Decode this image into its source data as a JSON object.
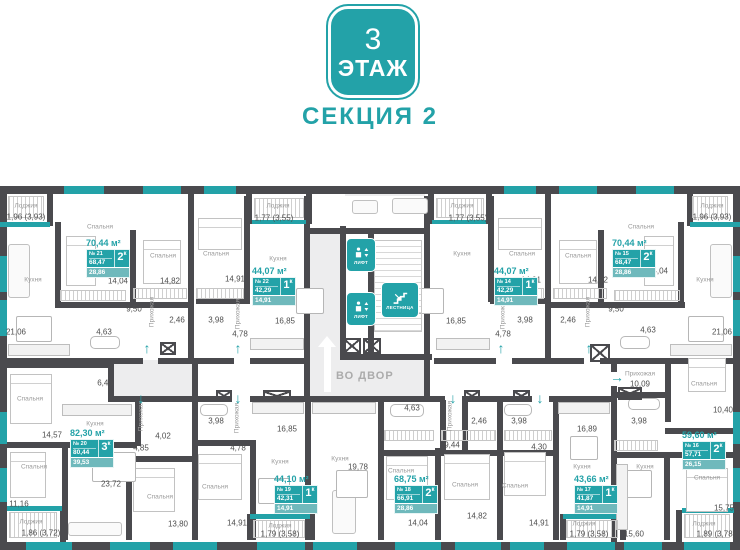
{
  "header": {
    "floor_number": "3",
    "floor_word": "ЭТАЖ",
    "section_label": "СЕКЦИЯ 2"
  },
  "colors": {
    "teal": "#23a2a8",
    "wall": "#4a4a4e",
    "outside": "#ededee",
    "badge_living_strip": "#6fb9bc"
  },
  "core": {
    "lift_label": "ЛИФТ",
    "stairs_label": "ЛЕСТНИЦА",
    "exit_label": "ВО ДВОР"
  },
  "apartments": [
    {
      "id": "21",
      "number": "№ 21",
      "rooms": "2",
      "rooms_unit": "к",
      "area_title": "70,44 м²",
      "area_total": "68,47",
      "area_living": "28,86",
      "x": 86,
      "y": 238
    },
    {
      "id": "22",
      "number": "№ 22",
      "rooms": "1",
      "rooms_unit": "к",
      "area_title": "44,07 м²",
      "area_total": "42,29",
      "area_living": "14,91",
      "x": 252,
      "y": 266
    },
    {
      "id": "14",
      "number": "№ 14",
      "rooms": "1",
      "rooms_unit": "к",
      "area_title": "44,07 м²",
      "area_total": "42,29",
      "area_living": "14,91",
      "x": 494,
      "y": 266
    },
    {
      "id": "15",
      "number": "№ 15",
      "rooms": "2",
      "rooms_unit": "к",
      "area_title": "70,44 м²",
      "area_total": "68,47",
      "area_living": "28,86",
      "x": 612,
      "y": 238
    },
    {
      "id": "20",
      "number": "№ 20",
      "rooms": "3",
      "rooms_unit": "к",
      "area_title": "82,30 м²",
      "area_total": "80,44",
      "area_living": "39,53",
      "x": 70,
      "y": 428
    },
    {
      "id": "19",
      "number": "№ 19",
      "rooms": "1",
      "rooms_unit": "к",
      "area_title": "44,10 м²",
      "area_total": "42,31",
      "area_living": "14,91",
      "x": 274,
      "y": 474
    },
    {
      "id": "18",
      "number": "№ 18",
      "rooms": "2",
      "rooms_unit": "к",
      "area_title": "68,75 м²",
      "area_total": "66,91",
      "area_living": "28,86",
      "x": 394,
      "y": 474
    },
    {
      "id": "17",
      "number": "№ 17",
      "rooms": "1",
      "rooms_unit": "к",
      "area_title": "43,66 м²",
      "area_total": "41,87",
      "area_living": "14,91",
      "x": 574,
      "y": 474
    },
    {
      "id": "16",
      "number": "№ 16",
      "rooms": "2",
      "rooms_unit": "к",
      "area_title": "59,60 м²",
      "area_total": "57,71",
      "area_living": "26,15",
      "x": 682,
      "y": 430
    }
  ],
  "room_labels": [
    [
      "Лоджия",
      26,
      206,
      0
    ],
    [
      "Спальня",
      100,
      227,
      0
    ],
    [
      "Спальня",
      163,
      256,
      0
    ],
    [
      "Кухня",
      33,
      280,
      0
    ],
    [
      "Прихожая",
      152,
      312,
      1
    ],
    [
      "Лоджия",
      278,
      206,
      0
    ],
    [
      "Спальня",
      216,
      254,
      0
    ],
    [
      "Кухня",
      278,
      259,
      0
    ],
    [
      "Прихожая",
      238,
      314,
      1
    ],
    [
      "Лоджия",
      462,
      206,
      0
    ],
    [
      "Кухня",
      462,
      254,
      0
    ],
    [
      "Спальня",
      522,
      254,
      0
    ],
    [
      "Прихожая",
      503,
      314,
      1
    ],
    [
      "Лоджия",
      712,
      206,
      0
    ],
    [
      "Спальня",
      641,
      227,
      0
    ],
    [
      "Спальня",
      578,
      256,
      0
    ],
    [
      "Кухня",
      705,
      280,
      0
    ],
    [
      "Прихожая",
      588,
      312,
      1
    ],
    [
      "Спальня",
      30,
      399,
      0
    ],
    [
      "Кухня",
      95,
      424,
      0
    ],
    [
      "Спальня",
      34,
      467,
      0
    ],
    [
      "Спальня",
      160,
      497,
      0
    ],
    [
      "Прихожая",
      141,
      416,
      1
    ],
    [
      "Лоджия",
      31,
      522,
      0
    ],
    [
      "Прихожая",
      237,
      418,
      1
    ],
    [
      "Кухня",
      280,
      462,
      0
    ],
    [
      "Спальня",
      215,
      487,
      0
    ],
    [
      "Лоджия",
      280,
      526,
      0
    ],
    [
      "Кухня",
      340,
      459,
      0
    ],
    [
      "Прихожая",
      450,
      416,
      1
    ],
    [
      "Спальня",
      401,
      471,
      0
    ],
    [
      "Спальня",
      465,
      485,
      0
    ],
    [
      "Кухня",
      582,
      467,
      0
    ],
    [
      "Спальня",
      515,
      486,
      0
    ],
    [
      "Лоджия",
      584,
      524,
      0
    ],
    [
      "Прихожая",
      640,
      374,
      0
    ],
    [
      "Спальня",
      704,
      384,
      0
    ],
    [
      "Кухня",
      645,
      467,
      0
    ],
    [
      "Спальня",
      707,
      478,
      0
    ],
    [
      "Лоджия",
      704,
      524,
      0
    ]
  ],
  "dim_labels": [
    [
      "1,96 (3,93)",
      26,
      217
    ],
    [
      "14,04",
      118,
      281
    ],
    [
      "14,82",
      170,
      281
    ],
    [
      "21,06",
      16,
      332
    ],
    [
      "9,50",
      134,
      309
    ],
    [
      "4,63",
      104,
      332
    ],
    [
      "2,46",
      177,
      320
    ],
    [
      "1,77 (3,55)",
      274,
      218
    ],
    [
      "14,91",
      235,
      279
    ],
    [
      "16,85",
      285,
      321
    ],
    [
      "4,78",
      240,
      334
    ],
    [
      "3,98",
      216,
      320
    ],
    [
      "1,77 (3,55)",
      468,
      218
    ],
    [
      "16,85",
      456,
      321
    ],
    [
      "14,91",
      531,
      280
    ],
    [
      "4,78",
      503,
      334
    ],
    [
      "3,98",
      525,
      320
    ],
    [
      "2,46",
      568,
      320
    ],
    [
      "1,96 (3,93)",
      712,
      217
    ],
    [
      "14,04",
      658,
      271
    ],
    [
      "14,82",
      598,
      280
    ],
    [
      "21,06",
      722,
      332
    ],
    [
      "9,50",
      616,
      309
    ],
    [
      "4,63",
      648,
      330
    ],
    [
      "14,57",
      52,
      435
    ],
    [
      "6,46",
      105,
      383
    ],
    [
      "11,16",
      19,
      504
    ],
    [
      "23,72",
      111,
      484
    ],
    [
      "13,80",
      178,
      524
    ],
    [
      "4,02",
      163,
      436
    ],
    [
      "4,85",
      141,
      448
    ],
    [
      "1,86 (3,72)",
      41,
      533
    ],
    [
      "3,98",
      216,
      421
    ],
    [
      "4,78",
      238,
      448
    ],
    [
      "16,85",
      287,
      429
    ],
    [
      "14,91",
      237,
      523
    ],
    [
      "1,79 (3,58)",
      280,
      534
    ],
    [
      "19,78",
      358,
      467
    ],
    [
      "9,44",
      452,
      445
    ],
    [
      "4,63",
      412,
      408
    ],
    [
      "2,46",
      479,
      421
    ],
    [
      "14,04",
      418,
      523
    ],
    [
      "14,82",
      477,
      516
    ],
    [
      "3,98",
      519,
      421
    ],
    [
      "4,30",
      539,
      447
    ],
    [
      "16,89",
      587,
      429
    ],
    [
      "14,91",
      539,
      523
    ],
    [
      "1,79 (3,58)",
      589,
      534
    ],
    [
      "10,09",
      640,
      384
    ],
    [
      "10,40",
      723,
      410
    ],
    [
      "3,98",
      639,
      421
    ],
    [
      "15,75",
      724,
      508
    ],
    [
      "15,60",
      634,
      534
    ],
    [
      "1,89 (3,78)",
      716,
      534
    ]
  ]
}
